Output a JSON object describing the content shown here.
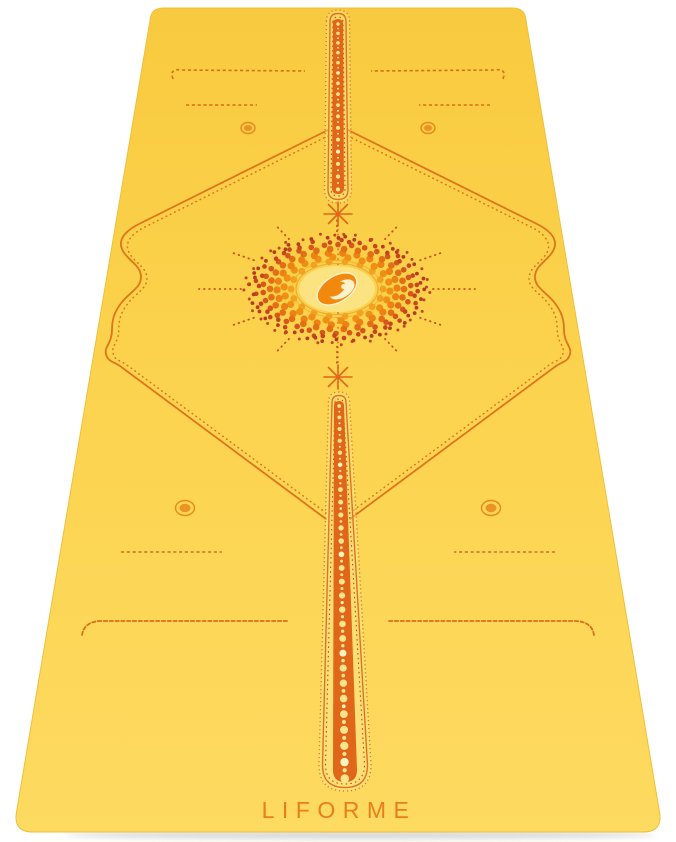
{
  "image": {
    "subject": "Liforme yoga mat, yellow with orange alignment guide markings",
    "view": "full-length perspective view, head end at top, white background"
  },
  "brand": {
    "wordmark": "LIFORME",
    "logo": "liforme-e-oval-logo"
  },
  "colors": {
    "background": "#FFFFFF",
    "mat_top": "#F8CA3F",
    "mat_mid": "#FCD34E",
    "mat_bottom": "#FDDA60",
    "mat_edge": "#EFBF3C",
    "marking": "#DE741C",
    "marking_light": "#E8881E",
    "marking_strong": "#E0661A",
    "stitch": "#D8701A",
    "ladder_dark": "#C1471E",
    "pale_dot": "#FBE48C",
    "wordmark_color": "#E87E1E",
    "sun_center_fill": "#FBE382",
    "sun_center_ring": "#F0A835",
    "logo_orange": "#F1890E",
    "logo_cream": "#FDF2CC",
    "shadow": "#BDBDBD"
  },
  "sun": {
    "cx": 337,
    "cy": 289,
    "squash": 0.6,
    "center": {
      "rx": 38,
      "ry": 23
    },
    "rings": [
      {
        "r": 46,
        "count": 18,
        "dot": 3.4,
        "color": "#F2A01C"
      },
      {
        "r": 53,
        "count": 22,
        "dot": 3.6,
        "color": "#EF9015"
      },
      {
        "r": 60,
        "count": 26,
        "dot": 3.6,
        "color": "#EC8114"
      },
      {
        "r": 67,
        "count": 30,
        "dot": 3.3,
        "color": "#E26E16"
      },
      {
        "r": 74,
        "count": 34,
        "dot": 2.8,
        "color": "#D4571C"
      },
      {
        "r": 80,
        "count": 40,
        "dot": 2.3,
        "color": "#C8441F"
      },
      {
        "r": 86,
        "count": 46,
        "dot": 1.9,
        "color": "#B73A22"
      },
      {
        "r": 91,
        "count": 40,
        "dot": 1.5,
        "color": "#C24522"
      }
    ],
    "rays": {
      "count": 12,
      "r0": 96,
      "r1": 124,
      "horizontal_extra": 14,
      "color": "#CC4E1E"
    }
  },
  "channels": [
    {
      "name": "top-center-line",
      "cx_top": 338,
      "y_top": 10,
      "w_top": 23,
      "cx_bot": 338,
      "y_bot": 203,
      "w_bot": 27,
      "band_top": 10,
      "band_bot": 12,
      "dot_top": 1.7,
      "dot_bot": 2.1,
      "spacing": 5.6
    },
    {
      "name": "bottom-center-line",
      "cx_top": 339,
      "y_top": 392,
      "w_top": 21,
      "cx_bot": 345,
      "y_bot": 791,
      "w_bot": 52,
      "band_top": 10,
      "band_bot": 24,
      "dot_top": 1.8,
      "dot_bot": 4.4,
      "spacing": 7
    }
  ],
  "stars": [
    {
      "x": 338,
      "y": 214
    },
    {
      "x": 338,
      "y": 377
    }
  ]
}
